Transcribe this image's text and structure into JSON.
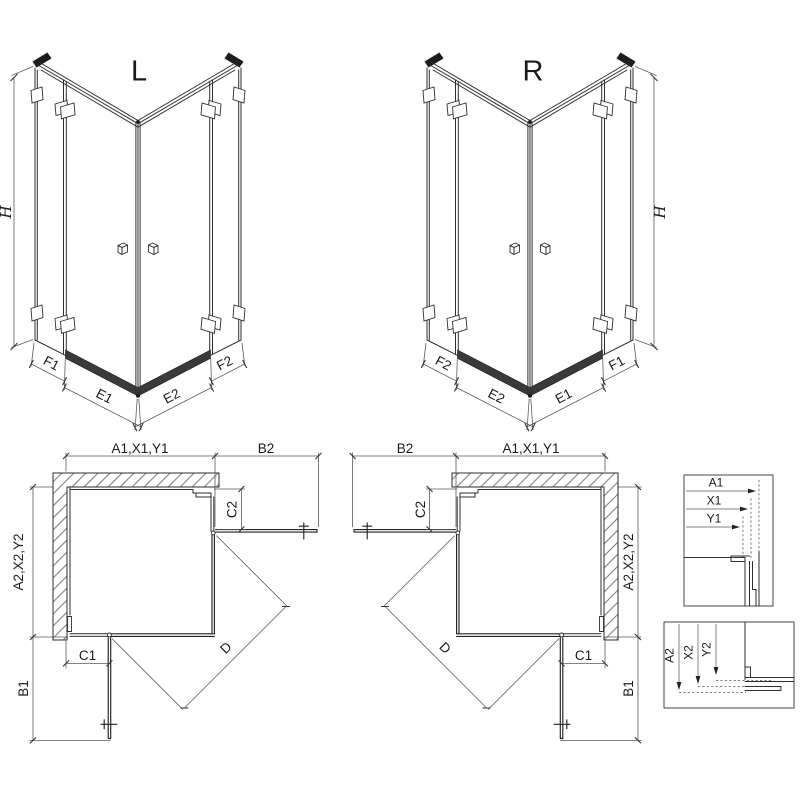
{
  "iso": {
    "left_label": "L",
    "right_label": "R",
    "height": "H",
    "fixed_left": "F1",
    "door_left": "E1",
    "door_right": "E2",
    "fixed_right": "F2"
  },
  "plan": {
    "width_top": "A1,X1,Y1",
    "door_reach_horizontal": "B2",
    "fixed_vertical": "C2",
    "depth_side": "A2,X2,Y2",
    "fixed_horizontal": "C1",
    "door_reach_vertical": "B1",
    "diagonal_entry": "D"
  },
  "details": {
    "horizontal": [
      "A1",
      "X1",
      "Y1"
    ],
    "vertical": [
      "A2",
      "X2",
      "Y2"
    ]
  },
  "colors": {
    "line": "#2e2e2e",
    "door_line": "#222222",
    "dimension": "#5a5a5a",
    "dark_profile": "#1c1c1c",
    "rail_band": "#3a3a3a",
    "hatch": "#666666",
    "text": "#1a1a1a",
    "background": "#ffffff"
  }
}
